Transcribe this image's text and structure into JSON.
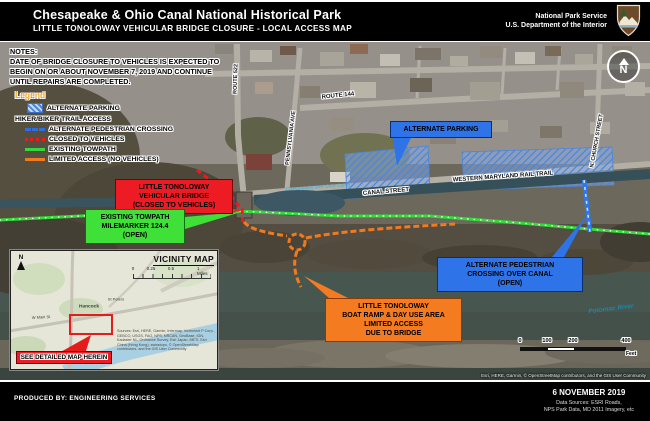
{
  "header": {
    "title": "Chesapeake & Ohio Canal National Historical Park",
    "subtitle": "LITTLE TONOLOWAY VEHICULAR BRIDGE CLOSURE - LOCAL ACCESS MAP",
    "agency_line1": "National Park Service",
    "agency_line2": "U.S. Department of the Interior",
    "logo": "nps-arrowhead"
  },
  "notes": {
    "text": "NOTES:\nDATE OF BRIDGE CLOSURE TO VEHICLES IS EXPECTED TO\nBEGIN ON OR ABOUT NOVEMBER 7, 2019 AND CONTINUE\nUNTIL REPAIRS ARE COMPLETED."
  },
  "legend": {
    "title": "Legend",
    "items": [
      {
        "label": "ALTERNATE PARKING",
        "swatch": "blue-hatch",
        "color": "#4a85d8"
      },
      {
        "label": "HIKER/BIKER TRAIL ACCESS",
        "swatch": "heading",
        "color": ""
      },
      {
        "label": "ALTERNATE PEDESTRIAN CROSSING",
        "swatch": "dashed-line",
        "color": "#2e6ee0"
      },
      {
        "label": "CLOSED TO VEHICLES",
        "swatch": "dotted-line",
        "color": "#ea1c1c"
      },
      {
        "label": "EXISTING TOWPATH",
        "swatch": "solid-line",
        "color": "#35d93a"
      },
      {
        "label": "LIMITED ACCESS (NO VEHICLES)",
        "swatch": "solid-line",
        "color": "#f17a1f"
      }
    ]
  },
  "callouts": {
    "vehicular_bridge": {
      "text": "LITTLE TONOLOWAY\nVEHICULAR BRIDGE\n(CLOSED TO VEHICLES)",
      "color": "#ed1c24"
    },
    "existing_towpath": {
      "text": "EXISTING TOWPATH\nMILEMARKER 124.4\n(OPEN)",
      "color": "#3fe139"
    },
    "alternate_parking": {
      "text": "ALTERNATE PARKING",
      "color": "#2e74e8"
    },
    "pedestrian_crossing": {
      "text": "ALTERNATE PEDESTRIAN\nCROSSING OVER CANAL\n(OPEN)",
      "color": "#2e74e8"
    },
    "boat_ramp": {
      "text": "LITTLE TONOLOWAY\nBOAT RAMP & DAY USE AREA\nLIMITED ACCESS\nDUE TO BRIDGE",
      "color": "#f47b20"
    }
  },
  "streets": {
    "route144": "ROUTE 144",
    "route522": "ROUTE 522",
    "pennsylvania": "PENNSYLVANIA AVE",
    "canal_street": "CANAL STREET",
    "rail_trail": "WESTERN MARYLAND RAIL TRAIL",
    "church": "N. CHURCH STREET"
  },
  "water": {
    "canal": "Chesapeake and Ohio Canal",
    "river": "Potomac River"
  },
  "north_arrow": {
    "label": "N"
  },
  "scalebar": {
    "labels": [
      "0",
      "100",
      "200",
      "400"
    ],
    "unit": "Feet"
  },
  "vicinity": {
    "title": "VICINITY MAP",
    "north": "N",
    "scale_labels": [
      "0",
      "0.25",
      "0.5",
      "1 Miles"
    ],
    "town": "Hancock",
    "poi": "St Peters",
    "street": "W Main St",
    "callout": "SEE DETAILED MAP HEREIN",
    "attribution": "Sources: Esri, HERE, Garmin, Intermap, increment P Corp., GEBCO, USGS, FAO, NPS, NRCAN, GeoBase, IGN, Kadaster NL, Ordnance Survey, Esri Japan, METI, Esri China (Hong Kong), swisstopo, © OpenStreetMap contributors, and the GIS User Community"
  },
  "map_attribution": "Esri, HERE, Garmin, © OpenStreetMap contributors, and the GIS User Community",
  "footer": {
    "produced_by": "PRODUCED BY: ENGINEERING SERVICES",
    "date": "6 NOVEMBER 2019",
    "sources": "Data Sources: ESRI Roads,\nNPS Park Data, MD 2011 Imagery, etc"
  }
}
